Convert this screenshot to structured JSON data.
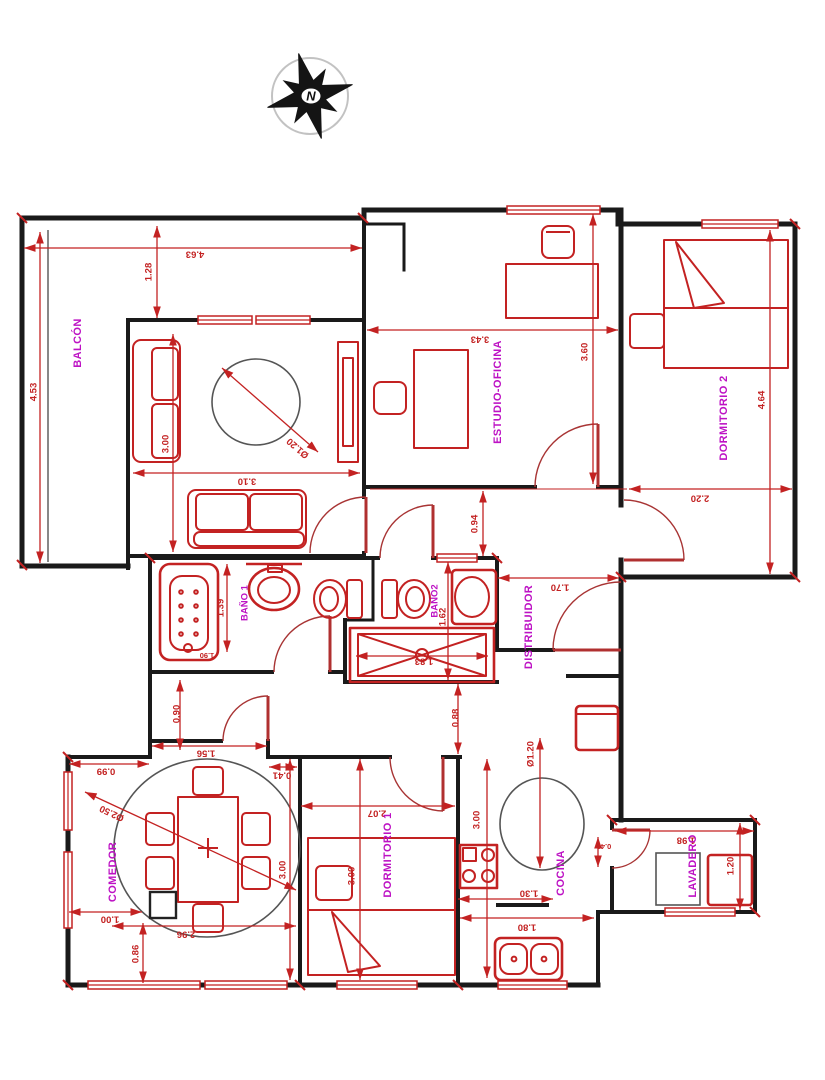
{
  "compass": {
    "north_label": "N"
  },
  "rooms": {
    "balcon": "BALCÓN",
    "estudio_oficina": "ESTUDIO-OFICINA",
    "dormitorio2": "DORMITORIO 2",
    "bano1": "BAÑO 1",
    "bano2": "BAÑO2",
    "distribuidor": "DISTRIBUIDOR",
    "comedor": "COMEDOR",
    "dormitorio1": "DORMITORIO 1",
    "cocina": "COCINA",
    "lavadero": "LAVADERO"
  },
  "dimensions": {
    "top_width": "4.63",
    "balcon_depth": "1.28",
    "balcon_length": "4.53",
    "sala_depth": "3.00",
    "sala_width": "3.10",
    "sala_rug": "Ø1.20",
    "estudio_width": "3.43",
    "estudio_depth": "3.60",
    "dorm2_width": "2.20",
    "dorm2_length": "4.64",
    "pasillo": "0.94",
    "distribuidor_width": "1.70",
    "bano1_width": "1.39",
    "bano1_tub": "1.90",
    "bano2_width": "1.62",
    "ducha_length": "1.83",
    "pasillo2": "0.90",
    "pasillo3": "0.88",
    "comedor_top1": "0.99",
    "comedor_top2": "1.56",
    "comedor_top3": "0.41",
    "comedor_circle": "Ø2.50",
    "comedor_depth": "3.00",
    "comedor_b1": "1.00",
    "comedor_b2": "0.86",
    "comedor_width": "2.96",
    "dorm1_width": "2.07",
    "dorm1_depth": "3.00",
    "cocina_depth": "3.00",
    "cocina_circle": "Ø1.20",
    "cocina_counter": "1.30",
    "cocina_width": "1.80",
    "lavadero_door": "0.40",
    "lavadero_width": "1.98",
    "lavadero_depth": "1.20"
  },
  "colors": {
    "wall": "#1a1a1a",
    "red": "#c32222",
    "label_magenta": "#bd12c4"
  }
}
